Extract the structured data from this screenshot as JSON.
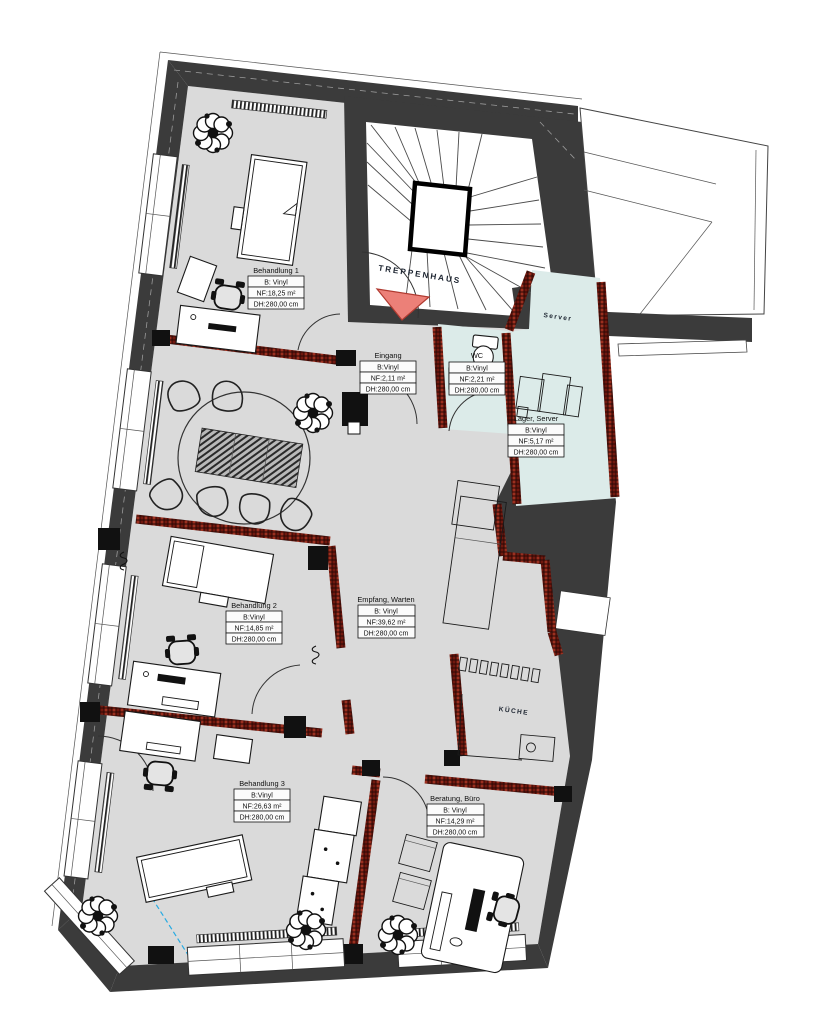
{
  "plan": {
    "labels": {
      "treppenhaus": "TREPPENHAUS",
      "kueche": "KÜCHE",
      "server_room": "Server"
    },
    "rooms": [
      {
        "id": "behandlung-1",
        "name": "Behandlung 1",
        "belag": "B: Vinyl",
        "nf": "NF:18,25 m²",
        "dh": "DH:280,00 cm"
      },
      {
        "id": "eingang",
        "name": "Eingang",
        "belag": "B:Vinyl",
        "nf": "NF:2,11 m²",
        "dh": "DH:280,00 cm"
      },
      {
        "id": "wc",
        "name": "WC",
        "belag": "B:Vinyl",
        "nf": "NF:2,21 m²",
        "dh": "DH:280,00 cm"
      },
      {
        "id": "lager-server",
        "name": "Lager, Server",
        "belag": "B:Vinyl",
        "nf": "NF:5,17 m²",
        "dh": "DH:280,00 cm"
      },
      {
        "id": "behandlung-2",
        "name": "Behandlung 2",
        "belag": "B:Vinyl",
        "nf": "NF:14,85 m²",
        "dh": "DH:280,00 cm"
      },
      {
        "id": "empfang-warten",
        "name": "Empfang, Warten",
        "belag": "B: Vinyl",
        "nf": "NF:39,62 m²",
        "dh": "DH:280,00 cm"
      },
      {
        "id": "behandlung-3",
        "name": "Behandlung 3",
        "belag": "B:Vinyl",
        "nf": "NF:26,63 m²",
        "dh": "DH:280,00 cm"
      },
      {
        "id": "beratung-buero",
        "name": "Beratung, Büro",
        "belag": "B: Vinyl",
        "nf": "NF:14,29 m²",
        "dh": "DH:280,00 cm"
      }
    ],
    "colors": {
      "wall": "#3b3b3b",
      "floor": "#dadada",
      "wet_room": "#dcebe9",
      "brick_wall": "#8f2a1c",
      "entrance_arrow": "#ec8078"
    }
  }
}
